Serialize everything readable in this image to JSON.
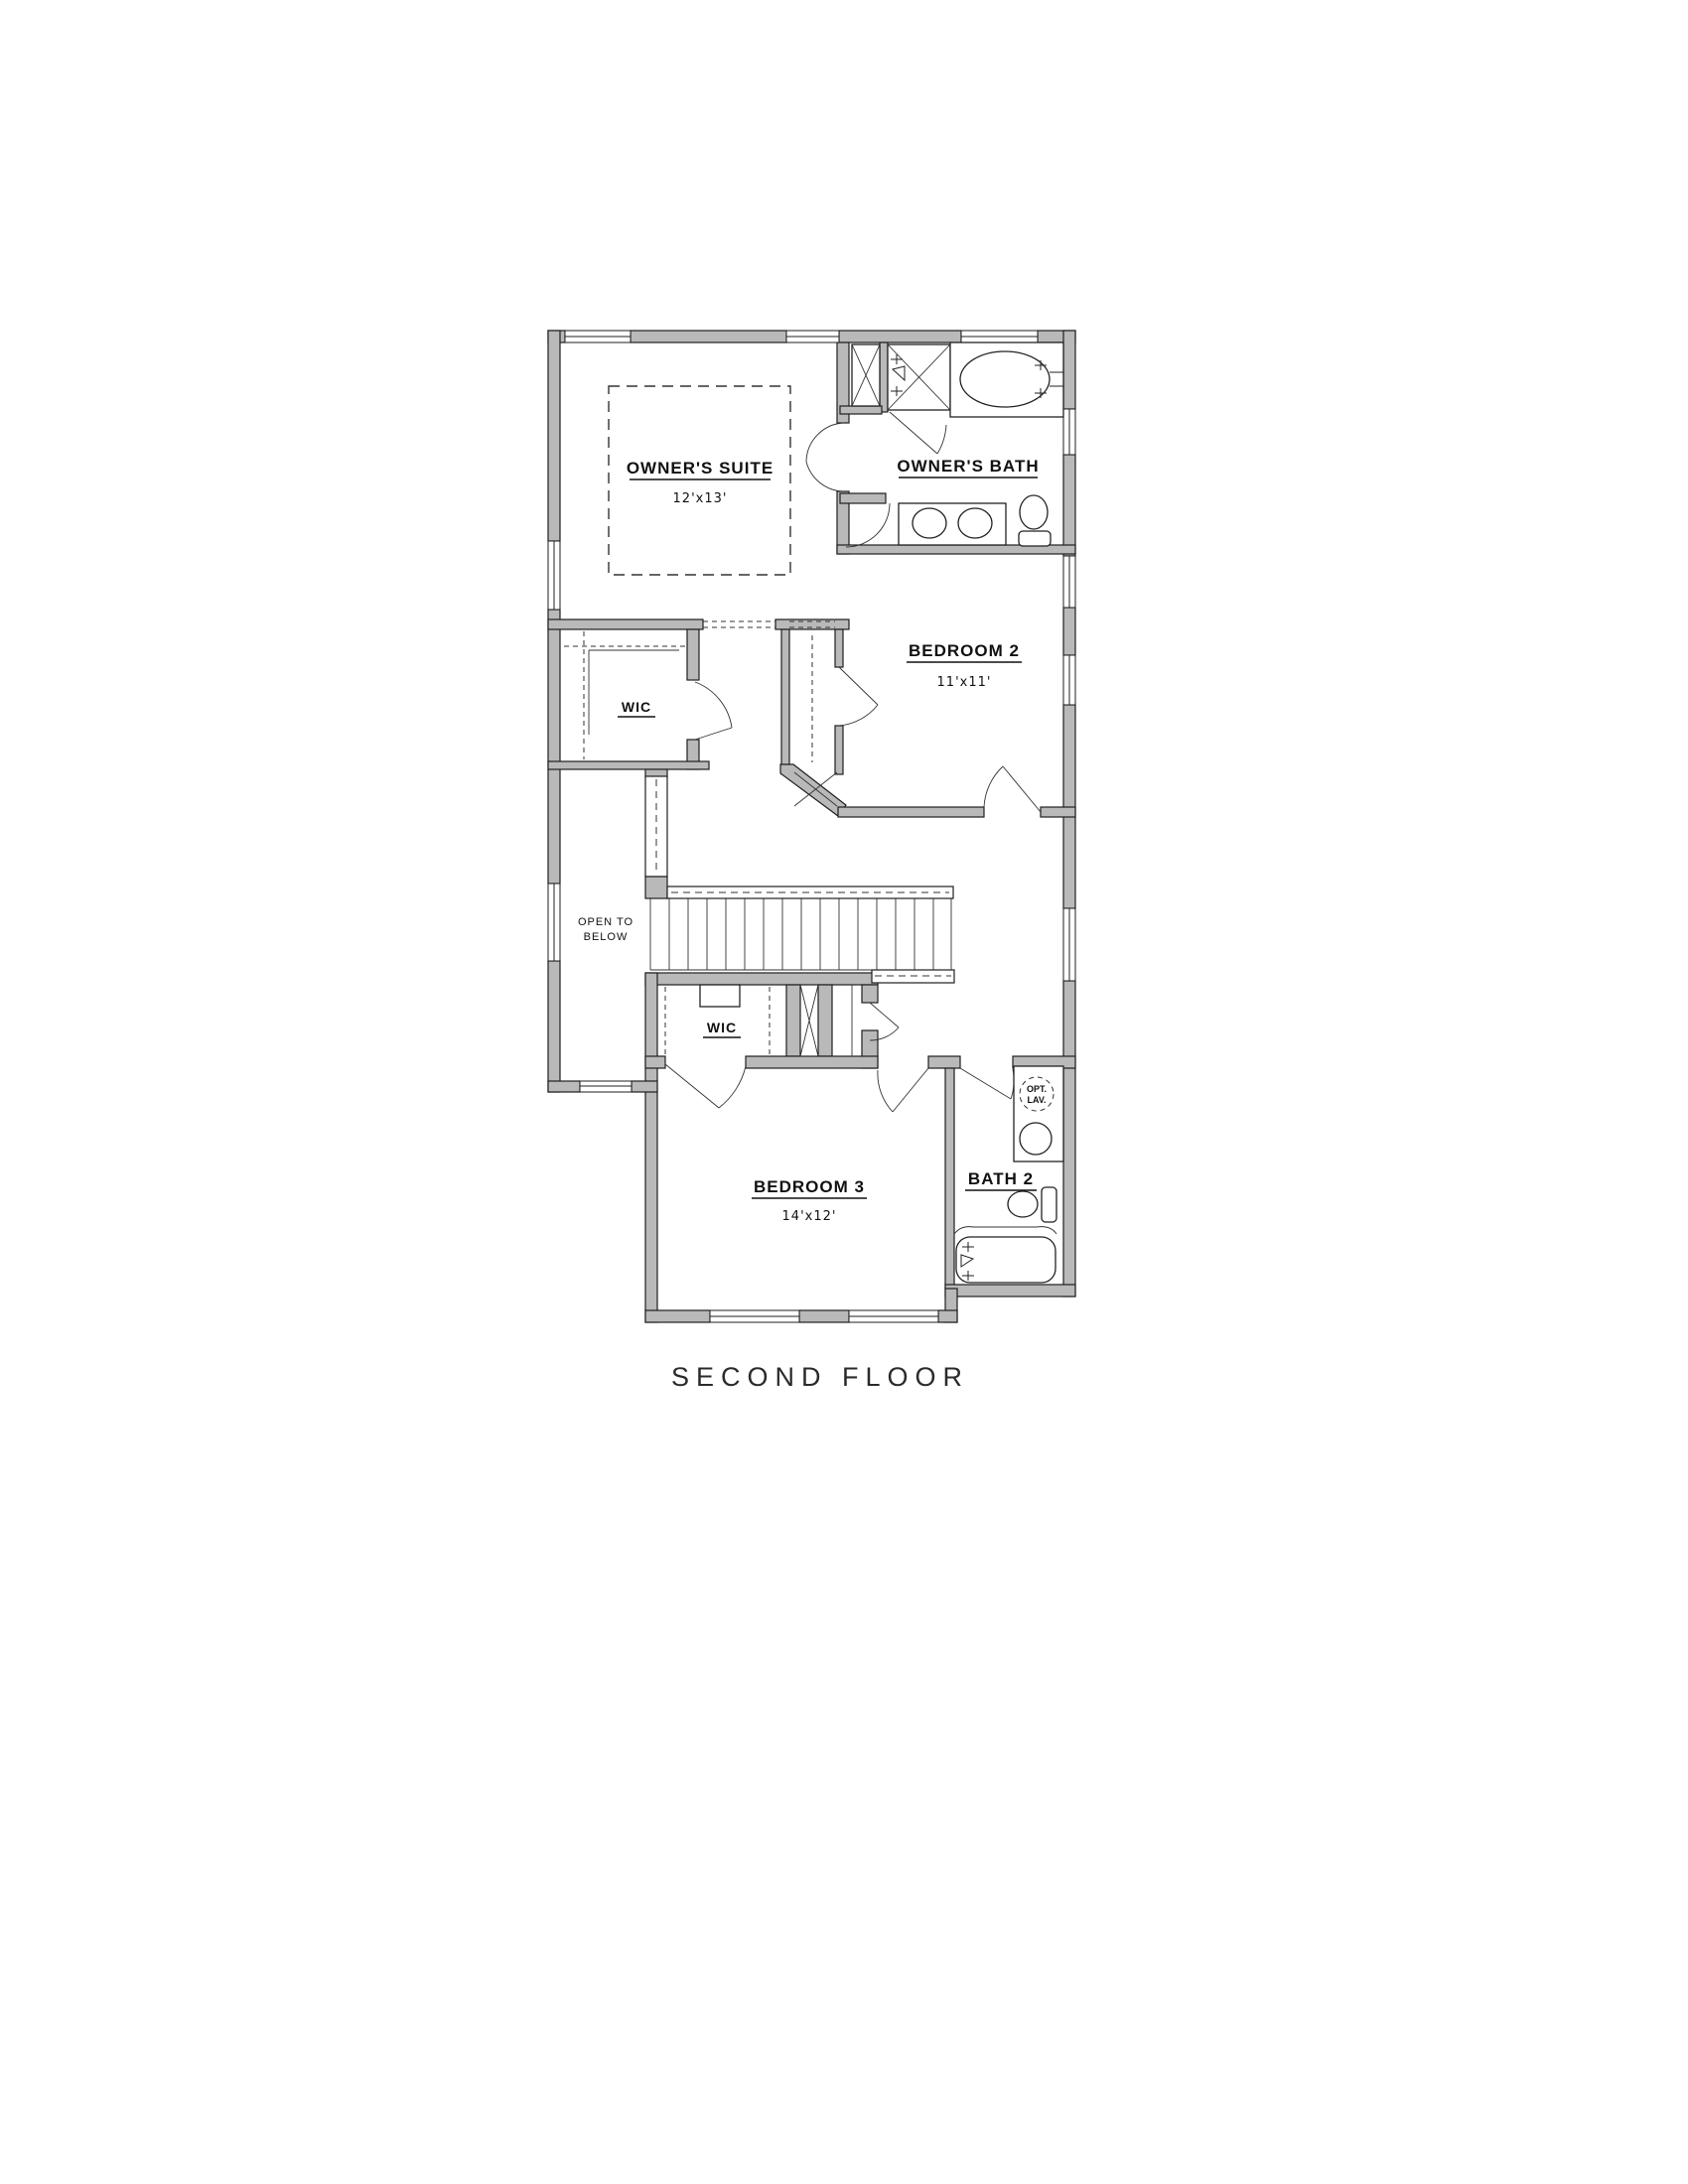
{
  "title": "SECOND FLOOR",
  "colors": {
    "background": "#ffffff",
    "wall_fill": "#b9b9b9",
    "line": "#1f1f1f",
    "text": "#111111"
  },
  "rooms": {
    "owners_suite": {
      "label": "OWNER'S SUITE",
      "dims": "12'x13'"
    },
    "owners_bath": {
      "label": "OWNER'S BATH"
    },
    "bedroom2": {
      "label": "BEDROOM 2",
      "dims": "11'x11'"
    },
    "bedroom3": {
      "label": "BEDROOM 3",
      "dims": "14'x12'"
    },
    "bath2": {
      "label": "BATH 2"
    },
    "wic_upper": {
      "label": "WIC"
    },
    "wic_lower": {
      "label": "WIC"
    },
    "open_to_below": {
      "line1": "OPEN TO",
      "line2": "BELOW"
    },
    "opt_lav": {
      "line1": "OPT.",
      "line2": "LAV."
    }
  }
}
